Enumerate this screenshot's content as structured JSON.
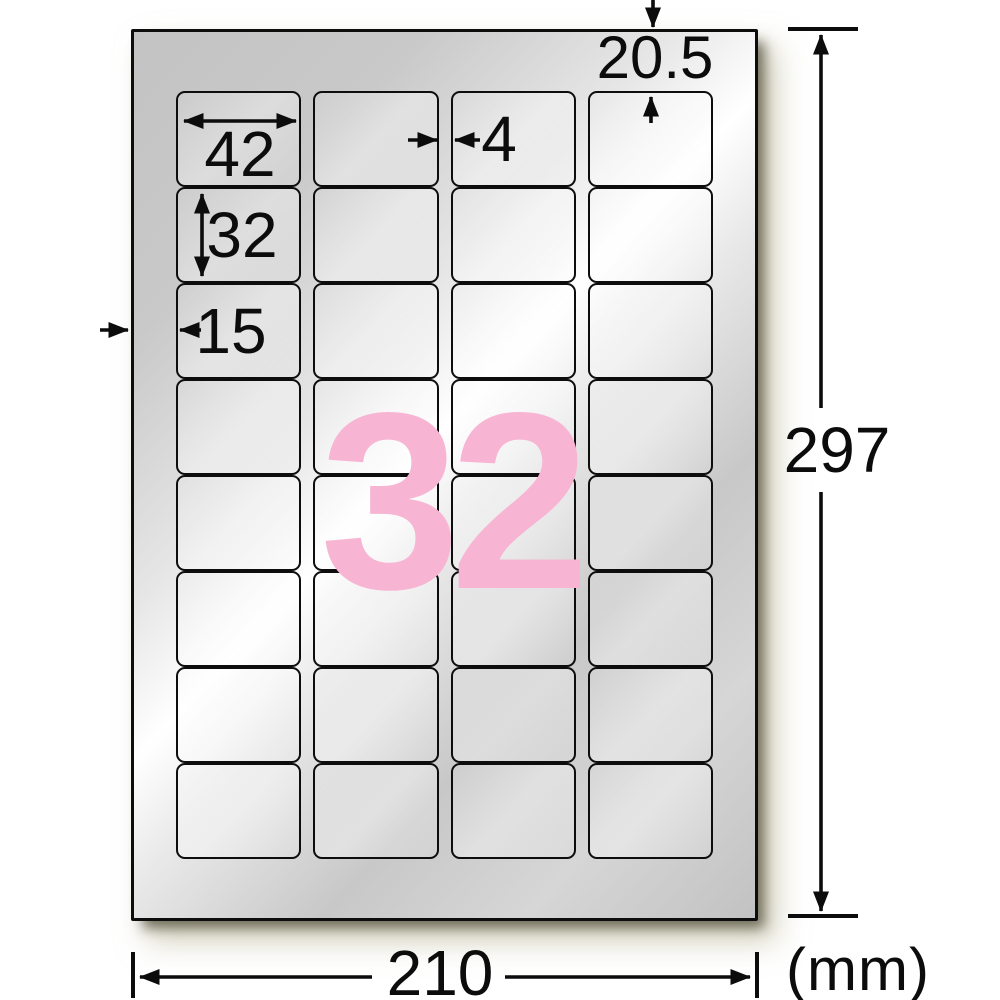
{
  "diagram": {
    "title_number": "32",
    "unit_label": "(mm)",
    "measurements": {
      "label_width": "42",
      "label_height": "32",
      "left_margin": "15",
      "column_gap": "4",
      "top_margin": "20.5",
      "sheet_width": "210",
      "sheet_height": "297"
    },
    "grid": {
      "columns": 4,
      "rows": 8,
      "total_labels": 32
    },
    "colors": {
      "count_pink": "#f7b5d3",
      "sheet_silver": "#c8c8c8",
      "line_black": "#0c0c0c",
      "shadow_beige": "#b6b08e"
    }
  }
}
